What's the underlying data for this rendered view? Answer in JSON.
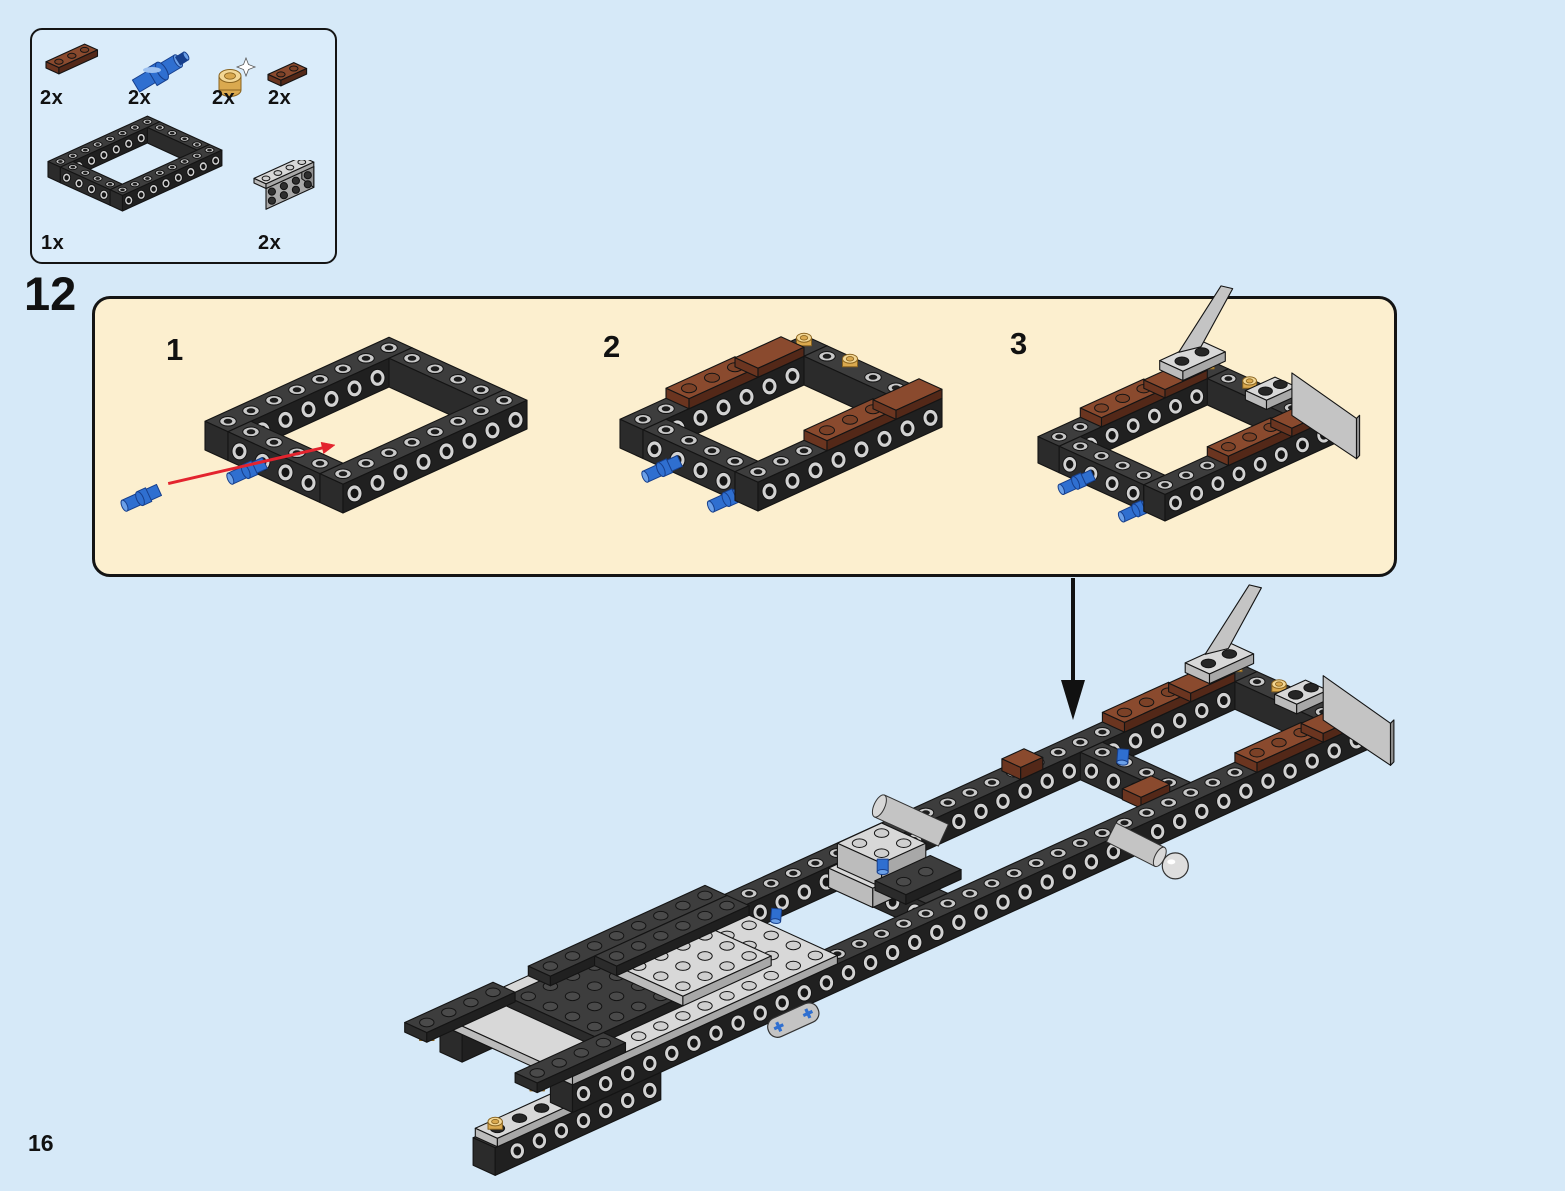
{
  "page": {
    "number": "16",
    "step_number": "12"
  },
  "parts_box": {
    "items": [
      {
        "name": "reddish-brown-plate-1x3",
        "qty": "2x"
      },
      {
        "name": "blue-technic-pin-long",
        "qty": "2x"
      },
      {
        "name": "pearl-gold-round-plate",
        "qty": "2x"
      },
      {
        "name": "reddish-brown-plate-1x2",
        "qty": "2x"
      },
      {
        "name": "black-technic-frame-6x8",
        "qty": "1x"
      },
      {
        "name": "light-gray-bracket-2x4",
        "qty": "2x"
      }
    ]
  },
  "substeps": [
    {
      "label": "1",
      "features": {
        "pins": 1,
        "loose_pin": true,
        "red_arrow": true,
        "brown": false,
        "gold": false,
        "brackets": false
      }
    },
    {
      "label": "2",
      "features": {
        "pins": 2,
        "loose_pin": false,
        "red_arrow": false,
        "brown": true,
        "gold": true,
        "brackets": false
      }
    },
    {
      "label": "3",
      "features": {
        "pins": 2,
        "loose_pin": false,
        "red_arrow": false,
        "brown": true,
        "gold": true,
        "brackets": true
      }
    }
  ],
  "main_assembly": {
    "down_arrow": true,
    "features": {
      "brown": true,
      "gold": true,
      "brackets": true
    }
  },
  "colors": {
    "background": "#d6e9f8",
    "panel_bg": "#fcefcf",
    "box_bg": "#daecfa",
    "outline": "#141414",
    "red_arrow": "#e3242e",
    "black_arrow": "#111111",
    "brick": {
      "top": "#3d3d3d",
      "left": "#2b2b2b",
      "front": "#202020",
      "stud_ring": "#c9c9c9",
      "stud_hole": "#1d1d1d",
      "stud_top": "#4a4a4a",
      "stud_dark": "#262626",
      "hole_ring": "#d2d2d2",
      "hole_in": "#161616"
    },
    "gray": {
      "top": "#d8d8d8",
      "left": "#bcbcbc",
      "front": "#a8a8a8",
      "mid": "#c4c4c4",
      "dark": "#8f8f8f",
      "stud": "#cfcfcf"
    },
    "brown": {
      "top": "#8a4a2e",
      "left": "#6b3520",
      "front": "#532818",
      "stud": "#7b4127"
    },
    "blue": {
      "light": "#6ba0e8",
      "mid": "#2f6fd0",
      "dark": "#173f8c"
    },
    "gold": {
      "light": "#f3d795",
      "mid": "#daa94f",
      "dark": "#8a6420"
    },
    "tan": "#d9b878"
  }
}
